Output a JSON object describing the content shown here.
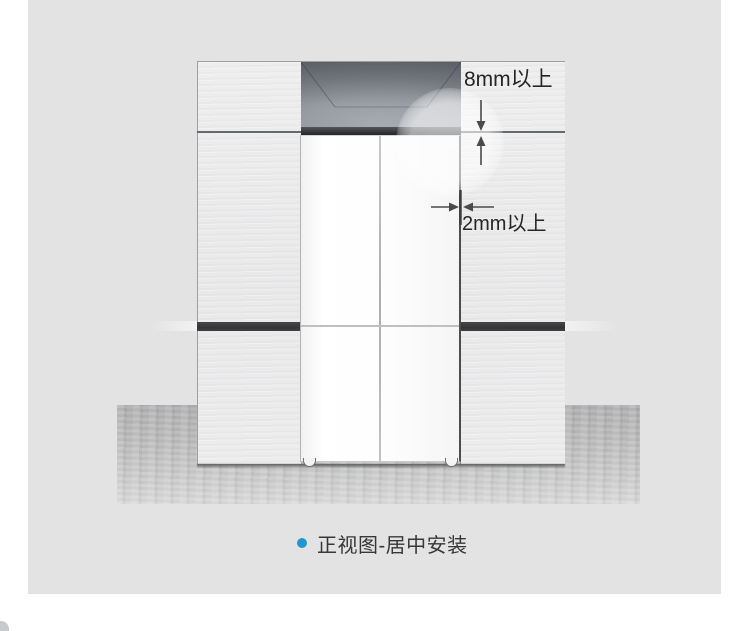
{
  "diagram": {
    "type": "installation-front-view",
    "annotations": {
      "top_clearance": "8mm以上",
      "side_clearance": "2mm以上"
    },
    "caption": {
      "text": "正视图-居中安装",
      "bullet_color": "#2196d3"
    },
    "colors": {
      "page_background": "#ffffff",
      "stage_background": "#e3e3e3",
      "cabinet_panel": "#ebebec",
      "recess_shadow": "#70747b",
      "dark_band": "#3a3a3c",
      "fridge_door": "#fdfdfd",
      "floor": "#bdbdbd",
      "dimension_line": "#4a4a4a",
      "accent_blue": "#2196d3",
      "label_text": "#262626"
    }
  }
}
